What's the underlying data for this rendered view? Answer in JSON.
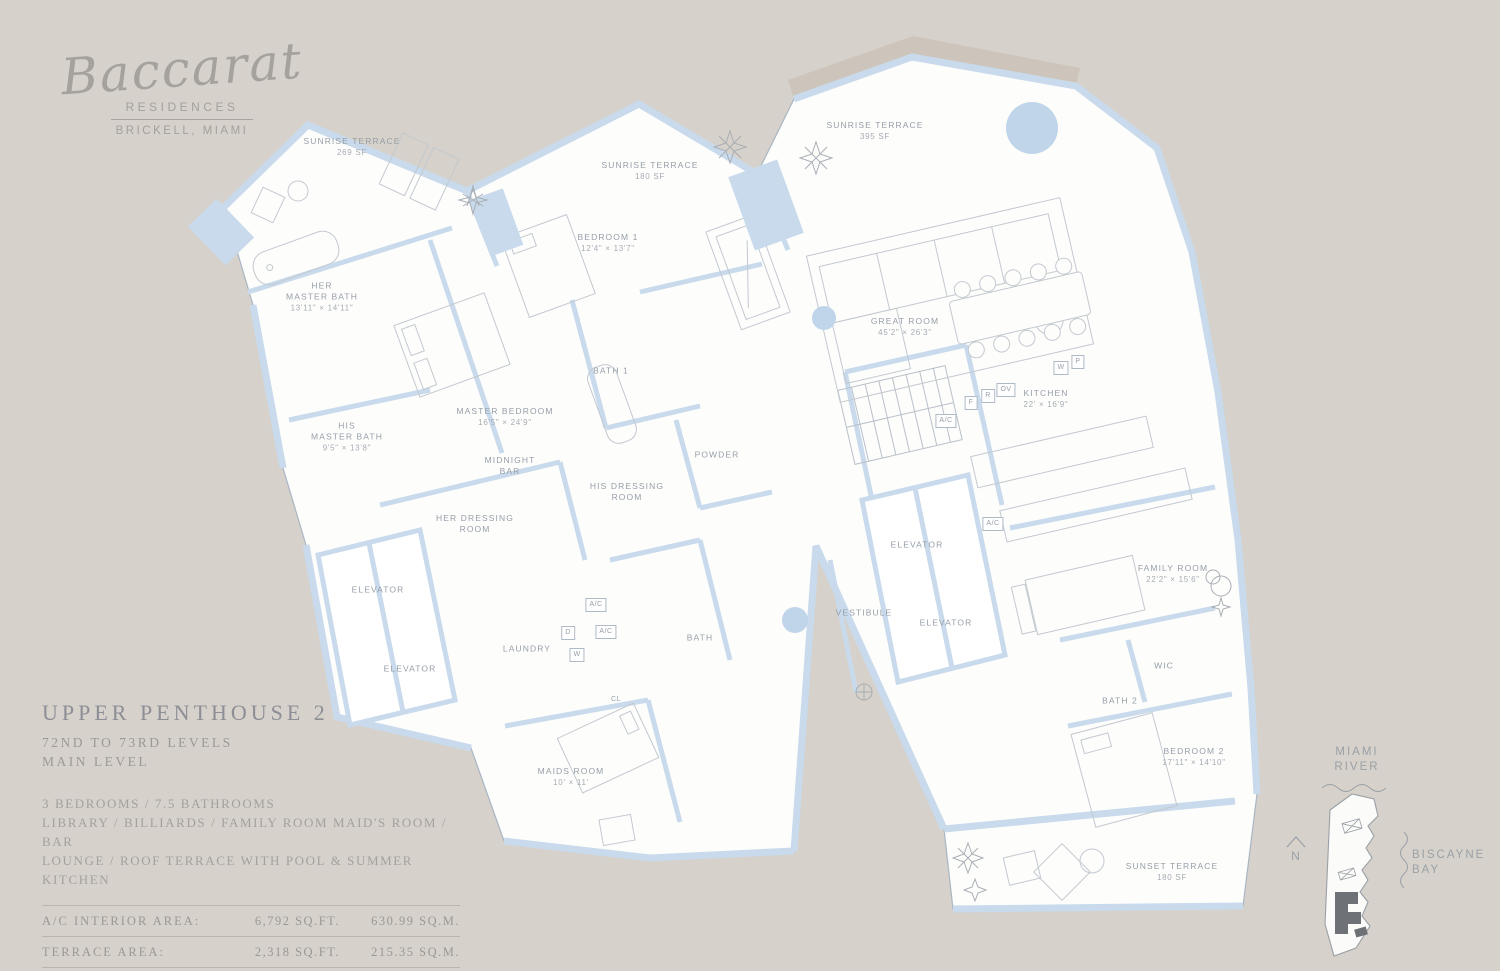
{
  "brand": {
    "name": "Baccarat",
    "sub1": "RESIDENCES",
    "sub2": "BRICKELL, MIAMI"
  },
  "unit": {
    "title": "UPPER PENTHOUSE 2",
    "levels": "72ND TO 73RD LEVELS",
    "level_note": "MAIN LEVEL",
    "features": [
      "3 BEDROOMS / 7.5 BATHROOMS",
      "LIBRARY / BILLIARDS / FAMILY ROOM  MAID'S ROOM / BAR",
      "LOUNGE / ROOF TERRACE WITH POOL & SUMMER KITCHEN"
    ]
  },
  "areas": {
    "rows": [
      {
        "label": "A/C INTERIOR AREA:",
        "sqft": "6,792 SQ.FT.",
        "sqm": "630.99 SQ.M."
      },
      {
        "label": "TERRACE AREA:",
        "sqft": "2,318 SQ.FT.",
        "sqm": "215.35 SQ.M."
      },
      {
        "label": "TOTAL RESIDENCE:",
        "sqft": "9,110 SQ.FT.",
        "sqm": "846.34 SQ.M."
      }
    ]
  },
  "plan": {
    "rooms": [
      {
        "x": 352,
        "y": 147,
        "name_lines": [
          "SUNRISE TERRACE"
        ],
        "dim": "269 SF"
      },
      {
        "x": 650,
        "y": 171,
        "name_lines": [
          "SUNRISE TERRACE"
        ],
        "dim": "180 SF"
      },
      {
        "x": 875,
        "y": 131,
        "name_lines": [
          "SUNRISE TERRACE"
        ],
        "dim": "395 SF"
      },
      {
        "x": 322,
        "y": 297,
        "name_lines": [
          "HER",
          "MASTER BATH"
        ],
        "dim": "13'11\" × 14'11\""
      },
      {
        "x": 608,
        "y": 243,
        "name_lines": [
          "BEDROOM 1"
        ],
        "dim": "12'4\" × 13'7\""
      },
      {
        "x": 905,
        "y": 327,
        "name_lines": [
          "GREAT ROOM"
        ],
        "dim": "45'2\" × 26'3\""
      },
      {
        "x": 505,
        "y": 417,
        "name_lines": [
          "MASTER BEDROOM"
        ],
        "dim": "16'5\" × 24'9\""
      },
      {
        "x": 611,
        "y": 371,
        "name_lines": [
          "BATH 1"
        ]
      },
      {
        "x": 347,
        "y": 437,
        "name_lines": [
          "HIS",
          "MASTER BATH"
        ],
        "dim": "9'5\" × 13'8\""
      },
      {
        "x": 1046,
        "y": 399,
        "name_lines": [
          "KITCHEN"
        ],
        "dim": "22' × 16'9\""
      },
      {
        "x": 510,
        "y": 466,
        "name_lines": [
          "MIDNIGHT",
          "BAR"
        ]
      },
      {
        "x": 717,
        "y": 455,
        "name_lines": [
          "POWDER"
        ]
      },
      {
        "x": 627,
        "y": 492,
        "name_lines": [
          "HIS DRESSING",
          "ROOM"
        ]
      },
      {
        "x": 475,
        "y": 524,
        "name_lines": [
          "HER DRESSING",
          "ROOM"
        ]
      },
      {
        "x": 378,
        "y": 590,
        "name_lines": [
          "ELEVATOR"
        ]
      },
      {
        "x": 410,
        "y": 669,
        "name_lines": [
          "ELEVATOR"
        ]
      },
      {
        "x": 917,
        "y": 545,
        "name_lines": [
          "ELEVATOR"
        ]
      },
      {
        "x": 946,
        "y": 623,
        "name_lines": [
          "ELEVATOR"
        ]
      },
      {
        "x": 864,
        "y": 613,
        "name_lines": [
          "VESTIBULE"
        ]
      },
      {
        "x": 527,
        "y": 649,
        "name_lines": [
          "LAUNDRY"
        ]
      },
      {
        "x": 700,
        "y": 638,
        "name_lines": [
          "BATH"
        ]
      },
      {
        "x": 1173,
        "y": 574,
        "name_lines": [
          "FAMILY ROOM"
        ],
        "dim": "22'2\" × 15'6\""
      },
      {
        "x": 1164,
        "y": 666,
        "name_lines": [
          "WIC"
        ]
      },
      {
        "x": 1120,
        "y": 701,
        "name_lines": [
          "BATH 2"
        ]
      },
      {
        "x": 1194,
        "y": 757,
        "name_lines": [
          "BEDROOM 2"
        ],
        "dim": "17'11\" × 14'10\""
      },
      {
        "x": 571,
        "y": 777,
        "name_lines": [
          "MAIDS ROOM"
        ],
        "dim": "10' × 11'"
      },
      {
        "x": 1172,
        "y": 872,
        "name_lines": [
          "SUNSET TERRACE"
        ],
        "dim": "180 SF"
      }
    ],
    "small_labels": [
      {
        "x": 946,
        "y": 421,
        "text": "A/C",
        "boxed": true
      },
      {
        "x": 993,
        "y": 524,
        "text": "A/C",
        "boxed": true
      },
      {
        "x": 596,
        "y": 605,
        "text": "A/C",
        "boxed": true
      },
      {
        "x": 606,
        "y": 632,
        "text": "A/C",
        "boxed": true
      },
      {
        "x": 568,
        "y": 633,
        "text": "D",
        "boxed": true
      },
      {
        "x": 577,
        "y": 655,
        "text": "W",
        "boxed": true
      },
      {
        "x": 616,
        "y": 700,
        "text": "CL",
        "boxed": false
      },
      {
        "x": 971,
        "y": 403,
        "text": "F",
        "boxed": true
      },
      {
        "x": 988,
        "y": 396,
        "text": "R",
        "boxed": true
      },
      {
        "x": 1006,
        "y": 390,
        "text": "OV",
        "boxed": true
      },
      {
        "x": 1061,
        "y": 368,
        "text": "W",
        "boxed": true
      },
      {
        "x": 1078,
        "y": 362,
        "text": "P",
        "boxed": true
      }
    ]
  },
  "keyplan": {
    "river_lines": [
      "MIAMI",
      "RIVER"
    ],
    "bay_lines": [
      "BISCAYNE",
      "BAY"
    ],
    "north_label": "N"
  },
  "colors": {
    "background": "#d6d1ca",
    "plan_fill": "#fdfdfc",
    "wall_blue": "#c8daeb",
    "line_gray": "#b9c0c8",
    "label_gray": "#969ea7",
    "unit_dark": "#6e7277"
  }
}
